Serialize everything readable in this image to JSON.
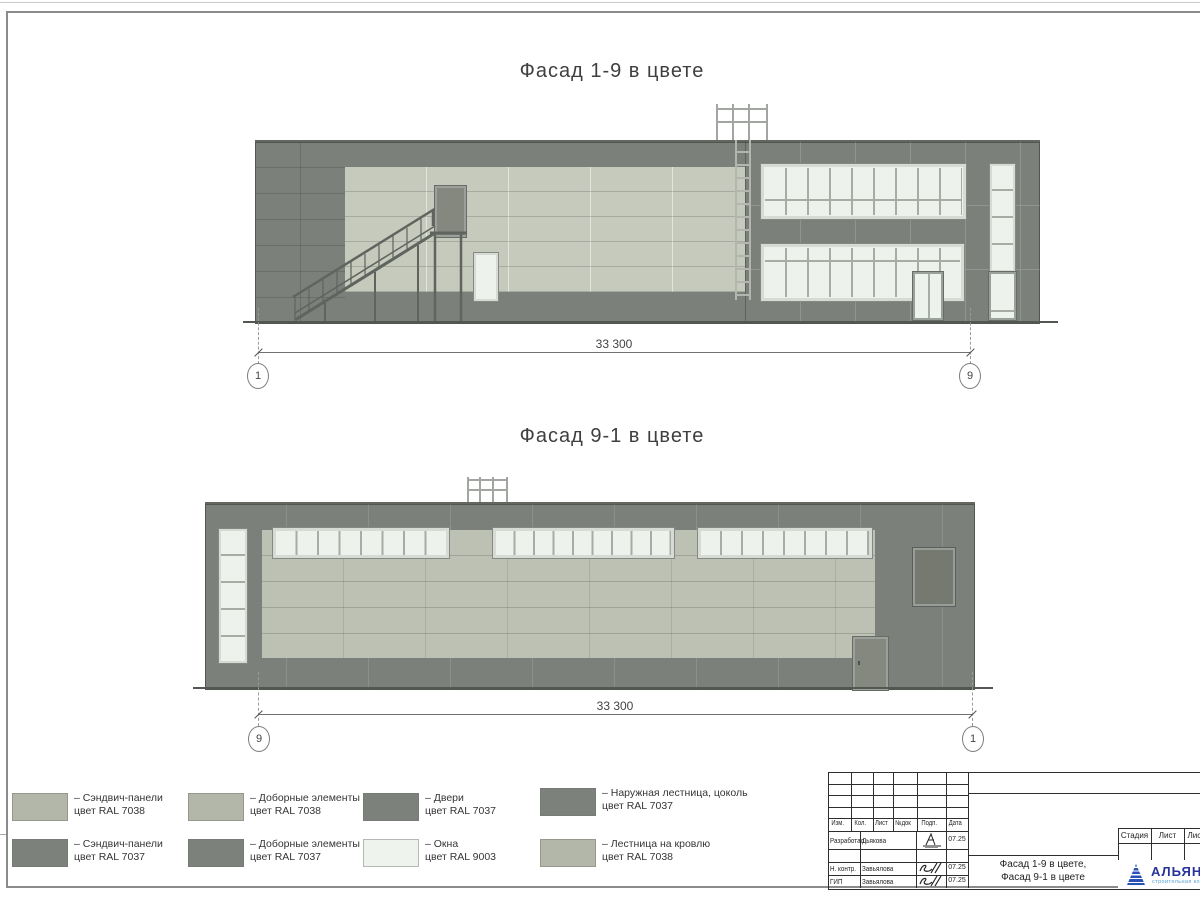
{
  "sheet": {
    "titles": {
      "facade1": "Фасад 1-9 в цвете",
      "facade2": "Фасад 9-1 в цвете"
    }
  },
  "colors": {
    "ral7037_dark_gray": "#7c807b",
    "ral7038_panel_light": "#c6cabd",
    "ral7038_panel_light2": "#bdc1b4",
    "ral9003_window_white": "#edf2ec",
    "swatch_ral7038": "#b3b7aa",
    "swatch_ral7037": "#7d817c",
    "swatch_ral9003": "#eef3ed",
    "logo_blue": "#27339b",
    "logo_light_blue": "#58a0d2"
  },
  "facade1": {
    "dim_value": "33 300",
    "axis_left": "1",
    "axis_right": "9"
  },
  "facade2": {
    "dim_value": "33 300",
    "axis_left": "9",
    "axis_right": "1"
  },
  "legend": {
    "items": [
      {
        "color": "#b3b7aa",
        "line1": "– Сэндвич-панели",
        "line2": "цвет RAL 7038"
      },
      {
        "color": "#b3b7aa",
        "line1": "– Доборные элементы",
        "line2": "цвет RAL 7038"
      },
      {
        "color": "#7d817c",
        "line1": "– Двери",
        "line2": "цвет RAL 7037"
      },
      {
        "color": "#7d817c",
        "line1": "– Наружная лестница, цоколь",
        "line2": "цвет RAL 7037"
      },
      {
        "color": "#7d817c",
        "line1": "– Сэндвич-панели",
        "line2": "цвет RAL 7037"
      },
      {
        "color": "#7d817c",
        "line1": "– Доборные элементы",
        "line2": "цвет RAL 7037"
      },
      {
        "color": "#eef3ed",
        "line1": "– Окна",
        "line2": "цвет RAL 9003"
      },
      {
        "color": "#b3b7aa",
        "line1": "– Лестница на кровлю",
        "line2": "цвет RAL 7038"
      }
    ]
  },
  "titleblock": {
    "header": [
      "Изм.",
      "Кол.",
      "Лист",
      "№док",
      "Подп.",
      "Дата"
    ],
    "rows": [
      {
        "role": "Разработал",
        "name": "Дьякова",
        "date": "07.25"
      },
      {
        "role": "Н. контр.",
        "name": "Завьялова",
        "date": "07.25"
      },
      {
        "role": "ГИП",
        "name": "Завьялова",
        "date": "07.25"
      }
    ],
    "doc_title_line1": "Фасад 1-9 в цвете,",
    "doc_title_line2": "Фасад 9-1 в цвете",
    "stage_header": [
      "Стадия",
      "Лист",
      "Листов"
    ],
    "logo_name": "АЛЬЯНС",
    "logo_sub": "строительная компания"
  }
}
